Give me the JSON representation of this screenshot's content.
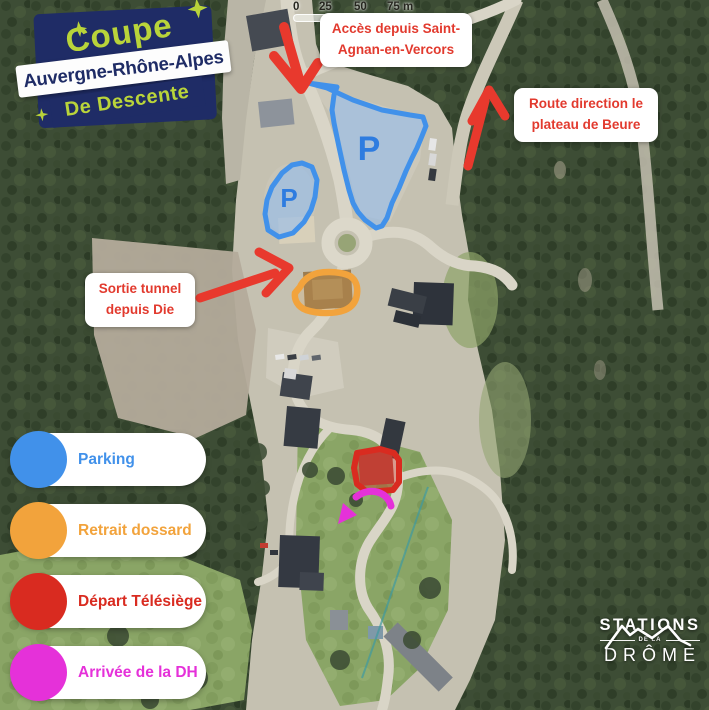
{
  "colors": {
    "navy": "#1f2c66",
    "lime": "#b9d43a",
    "label_red": "#e23a2e",
    "arrow_red": "#e8392d",
    "parking_blue": "#4191ea",
    "parking_letter": "#2e7ce0",
    "orange": "#f2a33c",
    "red": "#d92b20",
    "magenta": "#e531d9"
  },
  "title": {
    "line1": "Coupe",
    "line2": "Auvergne-Rhône-Alpes",
    "line3": "De Descente"
  },
  "scale_bar": {
    "ticks": [
      "0",
      "25",
      "50",
      "75 m"
    ]
  },
  "labels": {
    "access": "Accès depuis Saint-Agnan-en-Vercors",
    "route": "Route direction le plateau de Beure",
    "tunnel": "Sortie tunnel depuis Die"
  },
  "map": {
    "parking_symbol": "P"
  },
  "legend": {
    "items": [
      {
        "label": "Parking",
        "color": "#4191ea"
      },
      {
        "label": "Retrait dossard",
        "color": "#f2a33c"
      },
      {
        "label": "Départ Télésiège",
        "color": "#d92b20"
      },
      {
        "label": "Arrivée de la DH",
        "color": "#e531d9"
      }
    ]
  },
  "logo": {
    "name": "STATIONS",
    "middle": "DE LA",
    "region": "DRÔME"
  }
}
